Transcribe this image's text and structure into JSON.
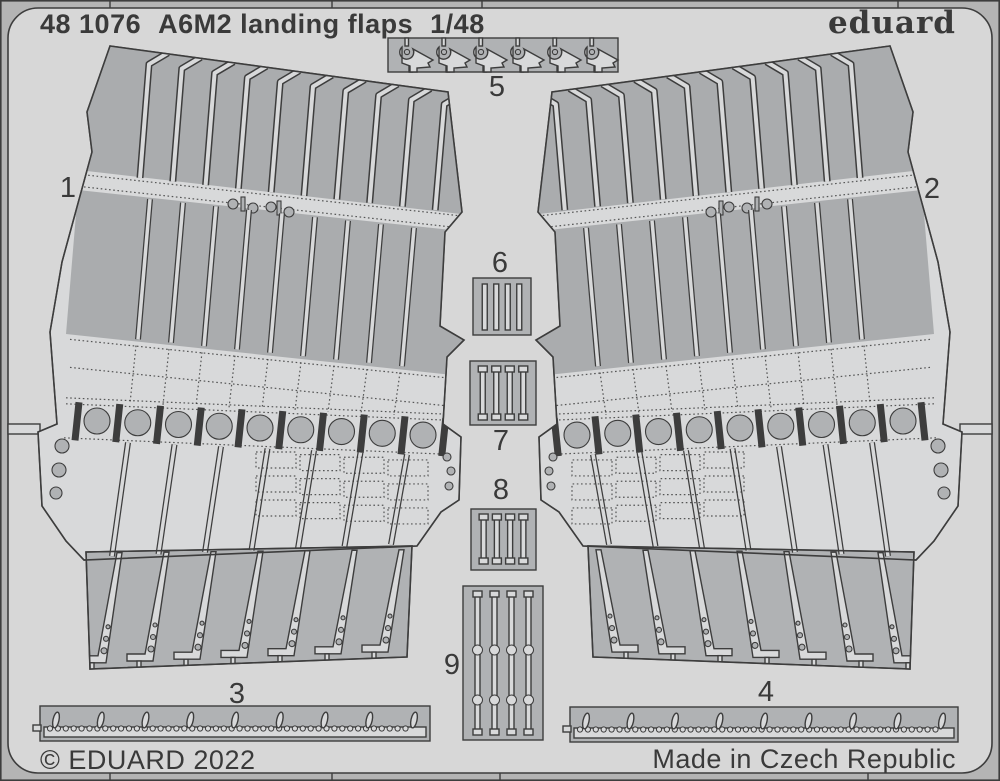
{
  "header": {
    "catalog_number": "48 1076",
    "product_title": "A6M2 landing flaps",
    "scale": "1/48",
    "brand": "eduard"
  },
  "footer": {
    "copyright": "© EDUARD 2022",
    "made_in": "Made in Czech Republic"
  },
  "sheet": {
    "part_labels": [
      "1",
      "2",
      "3",
      "4",
      "5",
      "6",
      "7",
      "8",
      "9"
    ]
  },
  "colors": {
    "frame": "#b4b4b4",
    "background": "#d7d7d7",
    "metal_light": "#d8d9da",
    "metal_medium": "#b0b2b4",
    "metal_dark": "#aaacae",
    "outline": "#3d3d3d",
    "text": "#3a3a3a"
  }
}
